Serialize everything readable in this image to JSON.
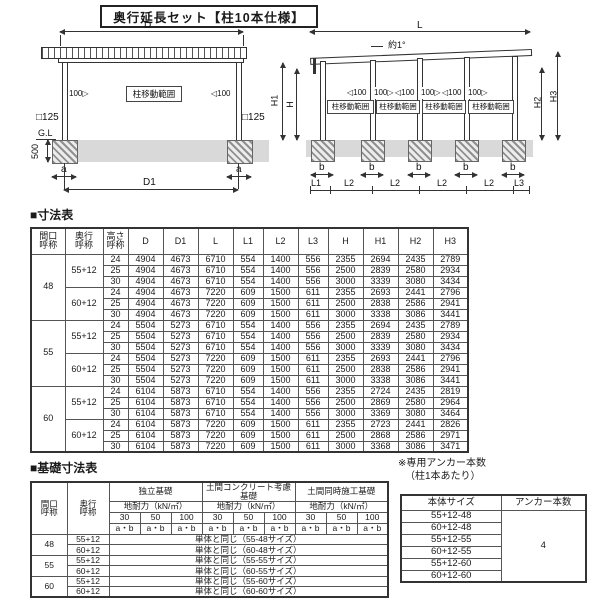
{
  "title": "奥行延長セット【柱10本仕様】",
  "diagram_left": {
    "dim_d": "D",
    "dim_d1": "D1",
    "dim_a": "a",
    "gl": "G.L",
    "dim_500": "500",
    "col_size": "□125",
    "move_range": "柱移動範囲",
    "arrow_right": "100▷",
    "arrow_left": "◁100"
  },
  "diagram_right": {
    "dim_l": "L",
    "slope": "約1°",
    "move_range": "柱移動範囲",
    "arrow_left": "◁100",
    "arrow_right": "100▷",
    "dim_h": "H",
    "dim_h1": "H1",
    "dim_h2": "H2",
    "dim_h3": "H3",
    "dim_b": "b",
    "dim_l1": "L1",
    "dim_l2": "L2",
    "dim_l3": "L3"
  },
  "dim_table": {
    "heading": "■寸法表",
    "col_headers": [
      "間口\n呼称",
      "奥行\n呼称",
      "高さ\n呼称",
      "D",
      "D1",
      "L",
      "L1",
      "L2",
      "L3",
      "H",
      "H1",
      "H2",
      "H3"
    ],
    "groups": [
      {
        "width": "48",
        "depths": [
          {
            "depth": "55+12",
            "rows": [
              {
                "h": "24",
                "values": [
                  4904,
                  4673,
                  6710,
                  554,
                  1400,
                  556,
                  2355,
                  2694,
                  2435,
                  2789
                ]
              },
              {
                "h": "25",
                "values": [
                  4904,
                  4673,
                  6710,
                  554,
                  1400,
                  556,
                  2500,
                  2839,
                  2580,
                  2934
                ]
              },
              {
                "h": "30",
                "values": [
                  4904,
                  4673,
                  6710,
                  554,
                  1400,
                  556,
                  3000,
                  3339,
                  3080,
                  3434
                ]
              }
            ]
          },
          {
            "depth": "60+12",
            "rows": [
              {
                "h": "24",
                "values": [
                  4904,
                  4673,
                  7220,
                  609,
                  1500,
                  611,
                  2355,
                  2693,
                  2441,
                  2796
                ]
              },
              {
                "h": "25",
                "values": [
                  4904,
                  4673,
                  7220,
                  609,
                  1500,
                  611,
                  2500,
                  2838,
                  2586,
                  2941
                ]
              },
              {
                "h": "30",
                "values": [
                  4904,
                  4673,
                  7220,
                  609,
                  1500,
                  611,
                  3000,
                  3338,
                  3086,
                  3441
                ]
              }
            ]
          }
        ]
      },
      {
        "width": "55",
        "depths": [
          {
            "depth": "55+12",
            "rows": [
              {
                "h": "24",
                "values": [
                  5504,
                  5273,
                  6710,
                  554,
                  1400,
                  556,
                  2355,
                  2694,
                  2435,
                  2789
                ]
              },
              {
                "h": "25",
                "values": [
                  5504,
                  5273,
                  6710,
                  554,
                  1400,
                  556,
                  2500,
                  2839,
                  2580,
                  2934
                ]
              },
              {
                "h": "30",
                "values": [
                  5504,
                  5273,
                  6710,
                  554,
                  1400,
                  556,
                  3000,
                  3339,
                  3080,
                  3434
                ]
              }
            ]
          },
          {
            "depth": "60+12",
            "rows": [
              {
                "h": "24",
                "values": [
                  5504,
                  5273,
                  7220,
                  609,
                  1500,
                  611,
                  2355,
                  2693,
                  2441,
                  2796
                ]
              },
              {
                "h": "25",
                "values": [
                  5504,
                  5273,
                  7220,
                  609,
                  1500,
                  611,
                  2500,
                  2838,
                  2586,
                  2941
                ]
              },
              {
                "h": "30",
                "values": [
                  5504,
                  5273,
                  7220,
                  609,
                  1500,
                  611,
                  3000,
                  3338,
                  3086,
                  3441
                ]
              }
            ]
          }
        ]
      },
      {
        "width": "60",
        "depths": [
          {
            "depth": "55+12",
            "rows": [
              {
                "h": "24",
                "values": [
                  6104,
                  5873,
                  6710,
                  554,
                  1400,
                  556,
                  2355,
                  2724,
                  2435,
                  2819
                ]
              },
              {
                "h": "25",
                "values": [
                  6104,
                  5873,
                  6710,
                  554,
                  1400,
                  556,
                  2500,
                  2869,
                  2580,
                  2964
                ]
              },
              {
                "h": "30",
                "values": [
                  6104,
                  5873,
                  6710,
                  554,
                  1400,
                  556,
                  3000,
                  3369,
                  3080,
                  3464
                ]
              }
            ]
          },
          {
            "depth": "60+12",
            "rows": [
              {
                "h": "24",
                "values": [
                  6104,
                  5873,
                  7220,
                  609,
                  1500,
                  611,
                  2355,
                  2723,
                  2441,
                  2826
                ]
              },
              {
                "h": "25",
                "values": [
                  6104,
                  5873,
                  7220,
                  609,
                  1500,
                  611,
                  2500,
                  2868,
                  2586,
                  2971
                ]
              },
              {
                "h": "30",
                "values": [
                  6104,
                  5873,
                  7220,
                  609,
                  1500,
                  611,
                  3000,
                  3368,
                  3086,
                  3471
                ]
              }
            ]
          }
        ]
      }
    ]
  },
  "foundation_table": {
    "heading": "■基礎寸法表",
    "col_width": "間口\n呼称",
    "col_depth": "奥行\n呼称",
    "group_headers": [
      "独立基礎",
      "土間コンクリート考慮基礎",
      "土間同時施工基礎"
    ],
    "load_label": "地耐力（kN/㎡）",
    "loads": [
      "30",
      "50",
      "100"
    ],
    "ab": "a・b",
    "rows": [
      {
        "width": "48",
        "depth": "55+12",
        "note": "単体と同じ（55-48サイズ）"
      },
      {
        "width": "48",
        "depth": "60+12",
        "note": "単体と同じ（60-48サイズ）"
      },
      {
        "width": "55",
        "depth": "55+12",
        "note": "単体と同じ（55-55サイズ）"
      },
      {
        "width": "55",
        "depth": "60+12",
        "note": "単体と同じ（60-55サイズ）"
      },
      {
        "width": "60",
        "depth": "55+12",
        "note": "単体と同じ（55-60サイズ）"
      },
      {
        "width": "60",
        "depth": "60+12",
        "note": "単体と同じ（60-60サイズ）"
      }
    ]
  },
  "anchor_note": {
    "line1": "※専用アンカー本数",
    "line2": "（柱1本あたり）"
  },
  "anchor_table": {
    "col_size": "本体サイズ",
    "col_count": "アンカー本数",
    "sizes": [
      "55+12-48",
      "60+12-48",
      "55+12-55",
      "60+12-55",
      "55+12-60",
      "60+12-60"
    ],
    "count": "4"
  }
}
